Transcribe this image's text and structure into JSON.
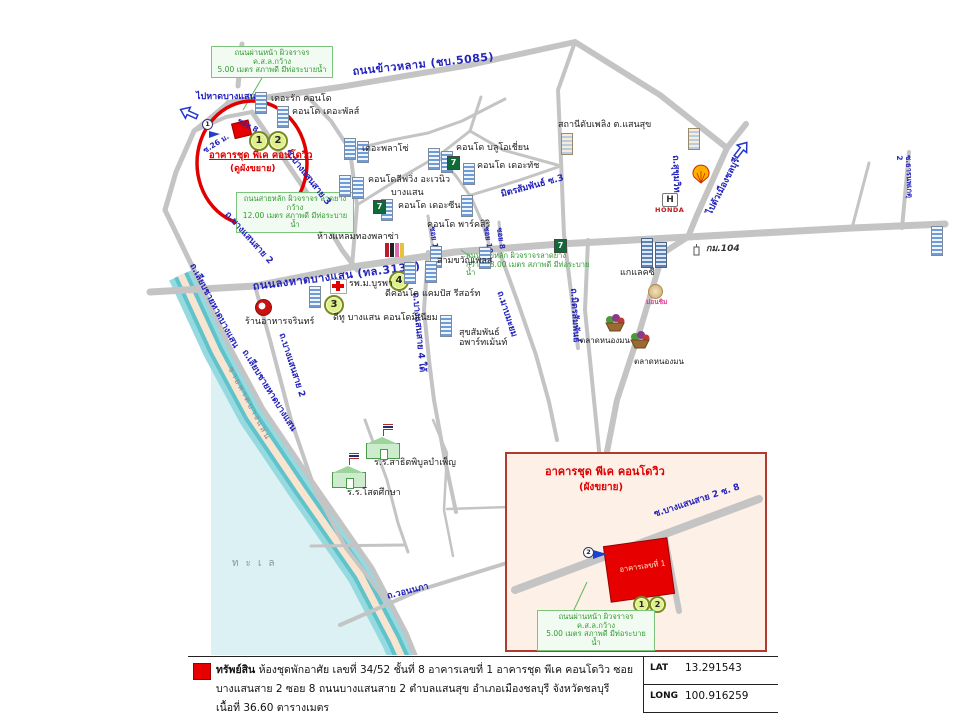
{
  "map": {
    "notes": {
      "front_road": "ถนนผ่านหน้า ผิวจราจร ค.ส.ล.กว้าง\n5.00 เมตร สภาพดี มีท่อระบายน้ำ",
      "main_12": "ถนนสายหลัก ผิวจราจร ลาดยาง กว้าง\n12.00 เมตร สภาพดี มีท่อระบายน้ำ",
      "main_18": "ถนนสายหลัก ผิวจราจรลาดยาง\nกว้าง 18.00 เมตร สภาพดี มีท่อระบายน้ำ"
    },
    "roads": {
      "khao_lam": "ถนนข้าวหลาม (ชบ.5085)",
      "to_beach": "ไปหาดบางแสน",
      "to_city": "ไปตัวเมืองชลบุรี",
      "bangsaen_sai2_upper": "ถ.บางแสนสาย 2",
      "bangsaen_sai3": "ซ.บางแสนสาย 3",
      "soi8_property": "ซอย 8",
      "soi26m": "ซ.26 ม.",
      "long_had_bangsaen": "ถนนลงหาดบางแสน (ทล.3137)",
      "mab_mayom": "ถ.มาบมะยม",
      "mit_samphan": "ถ.มิตรสัมพันธ์",
      "mit_samphan_soi3": "มิตรสัมพันธ์ ซ.3",
      "sukhumvit": "ถ.สุขุมวิท",
      "than_nop_ket2": "ซ.ธารนพเกตุ 2",
      "liab_beach_1": "ถ.เลียบชายหาดบางแสน",
      "liab_beach_2": "ถ.เลียบชายหาดบางแสน",
      "bangsaen_sai2_lower": "ถ.บางแสนสาย 2",
      "bangsaen_sai4_tai": "ถ.บางแสนสาย 4 ใต้",
      "wonnapha": "ถ.วอนนภา",
      "soi12": "ซอย 12",
      "soi10": "ซอย 10",
      "soi8": "ซอย 8"
    },
    "places": {
      "the_rak": "เดอะรัก คอนโด",
      "the_pulse": "คอนโด เดอะพัลส์",
      "the_plazo": "เดอะพลาโซ่",
      "blue_ocean": "คอนโด บลูโอเชี่ยน",
      "the_touch": "คอนโด เดอะทัช",
      "living_avenue": "คอนโดลีฟวิ่ง อะเวนิว",
      "living_avenue_2": "บางแสน",
      "the_zen": "คอนโด เดอะซีน",
      "park_siri": "คอนโด พาร์คสิริ",
      "fire_station": "สถานีดับเพลิง ต.แสนสุข",
      "sam_kwan_place": "สามขวัญเพลส",
      "dcondo": "ดีคอนโด แคมปัส รีสอร์ท",
      "d2_bangsaen": "ดีทู บางแสน คอนโดมิเนียม",
      "hospital": "รพ.ม.บูรพา",
      "laem_thong": "ห้างแหลมทองพลาซ่า",
      "suk_samphan": "สุขสัมพันธ์\nอพาร์ทเม้นท์",
      "galaxy": "แกแลคซี",
      "nong_mon_1": "ตลาดหนองมน",
      "nong_mon_2": "ตลาดหนองมน",
      "mon_chim": "ม่อนชิม",
      "jarin": "ร้านอาหารจรินทร์",
      "satit_school": "ร.ร.สาธิตพิบูลบำเพ็ญ",
      "sot_school": "ร.ร.โสตศึกษา"
    },
    "highlight": {
      "line1": "อาคารชุด พีเค คอนโดวิว",
      "line2": "(ดูผังขยาย)"
    },
    "markers": {
      "m1": "1",
      "m2": "2",
      "m3": "3",
      "m4": "4",
      "cam1": "1"
    },
    "misc": {
      "sea": "ทะเล",
      "beach": "ชายหาดบางแสน",
      "km104": "กม.104",
      "honda": "HONDA",
      "seven": "7"
    }
  },
  "inset": {
    "title": "อาคารชุด พีเค คอนโดวิว",
    "subtitle": "(ผังขยาย)",
    "road_label": "ซ.บางแสนสาย 2 ซ. 8",
    "building_label": "อาคารเลขที่ 1",
    "note": "ถนนผ่านหน้า ผิวจราจร ค.ส.ล.กว้าง\n5.00 เมตร สภาพดี มีท่อระบายน้ำ",
    "m1": "1",
    "m2": "2",
    "cam2": "2"
  },
  "legend": {
    "label": "ทรัพย์สิน",
    "line1": "ห้องชุดพักอาศัย เลขที่ 34/52 ชั้นที่ 8 อาคารเลขที่ 1 อาคารชุด พีเค คอนโดวิว ซอยบางแสนสาย 2 ซอย 8",
    "line2": "ถนนบางแสนสาย 2 ตำบลแสนสุข อำเภอเมืองชลบุรี จังหวัดชลบุรี เนื้อที่ 36.60 ตารางเมตร",
    "lat_label": "LAT",
    "lat_value": "13.291543",
    "long_label": "LONG",
    "long_value": "100.916259"
  },
  "colors": {
    "road": "#c4c4c4",
    "road_text": "#2323bd",
    "note_green": "#2f9a2f",
    "highlight_red": "#e00000",
    "sea": "#dbf1f3",
    "sand": "#f9e4cf"
  }
}
